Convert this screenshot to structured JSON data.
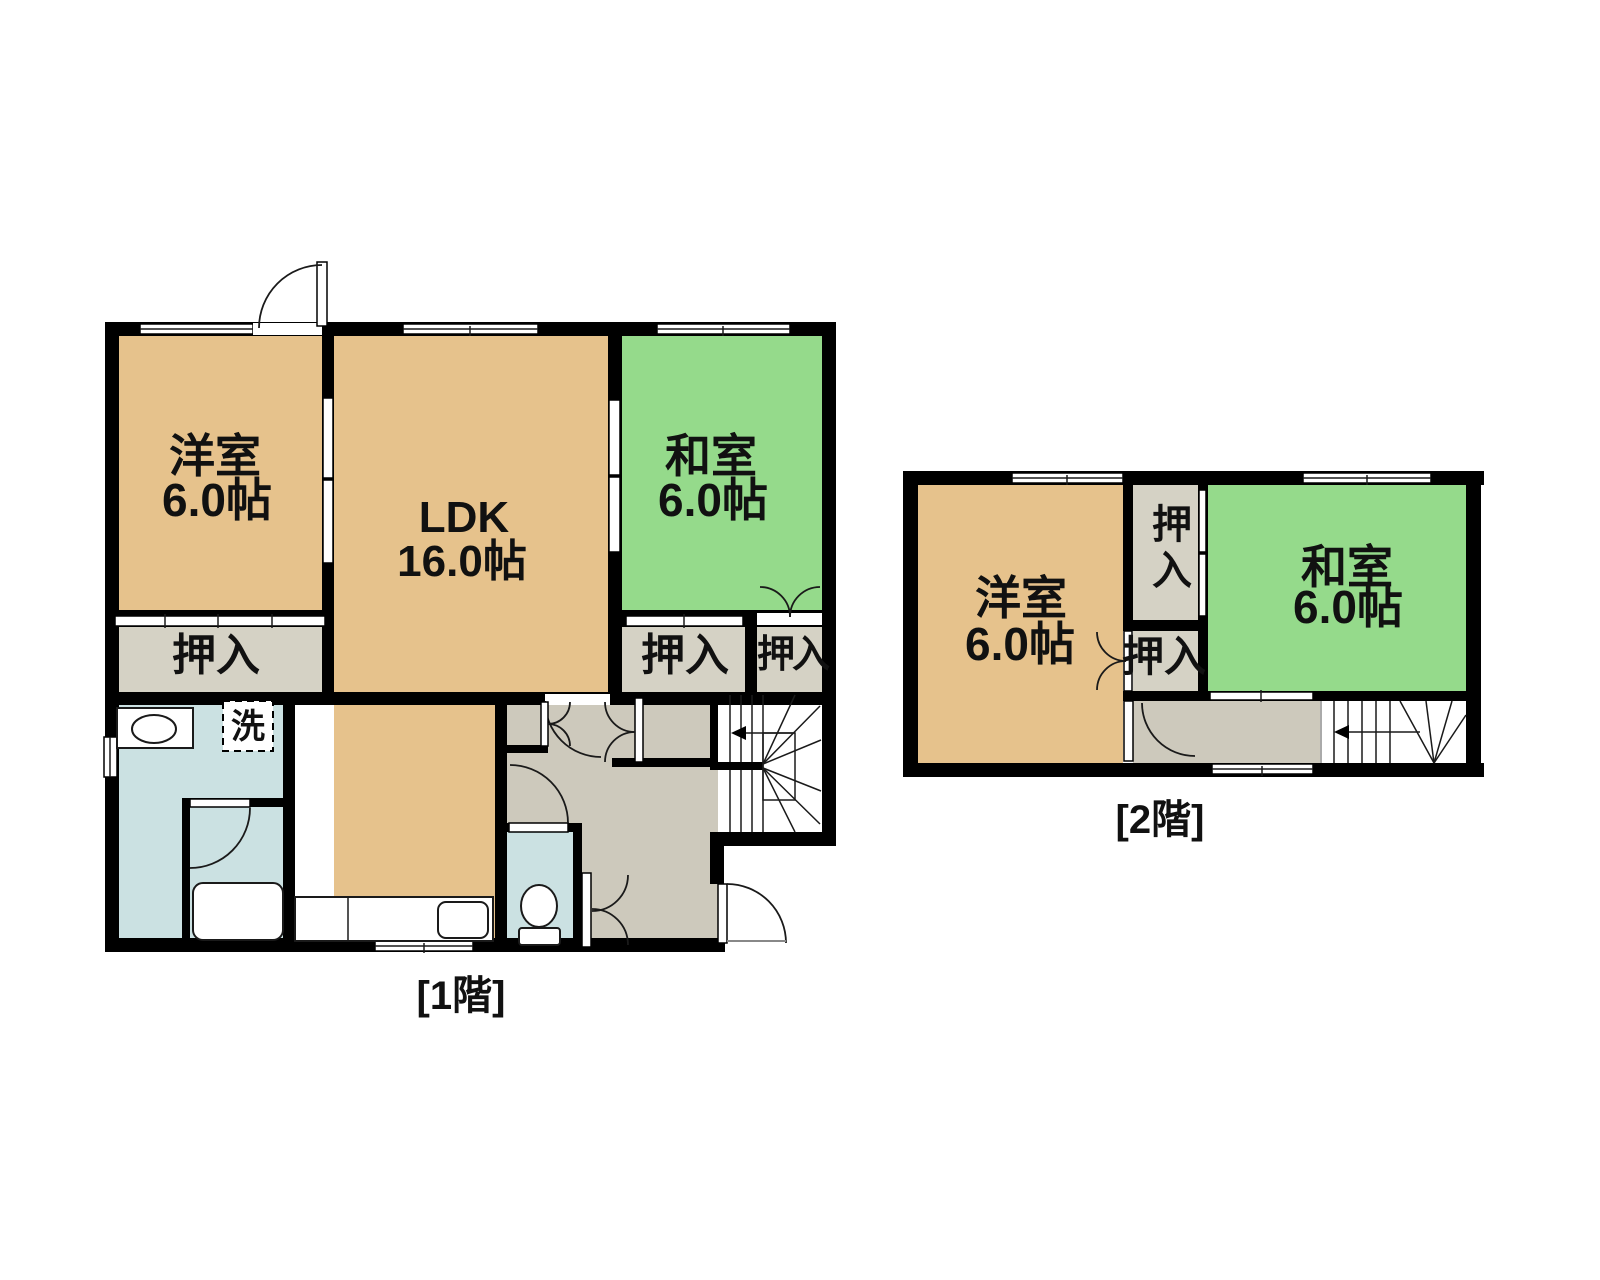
{
  "palette": {
    "wall": "#000000",
    "western_room": "#E6C28C",
    "japanese_room": "#95DA8B",
    "closet": "#D5D2C5",
    "hallway": "#CDC9BC",
    "wet_area": "#CBE1E2",
    "text": "#111111",
    "background": "#FFFFFF"
  },
  "floor1": {
    "caption": "[1階]",
    "western_room": {
      "name": "洋室",
      "size": "6.0帖"
    },
    "ldk": {
      "name": "LDK",
      "size": "16.0帖"
    },
    "japanese_room": {
      "name": "和室",
      "size": "6.0帖"
    },
    "closet_left": "押入",
    "closet_mid": "押入",
    "closet_right": "押入",
    "laundry": "洗"
  },
  "floor2": {
    "caption": "[2階]",
    "western_room": {
      "name": "洋室",
      "size": "6.0帖"
    },
    "japanese_room": {
      "name": "和室",
      "size": "6.0帖"
    },
    "closet_upper": "押入",
    "closet_lower": "押入"
  }
}
